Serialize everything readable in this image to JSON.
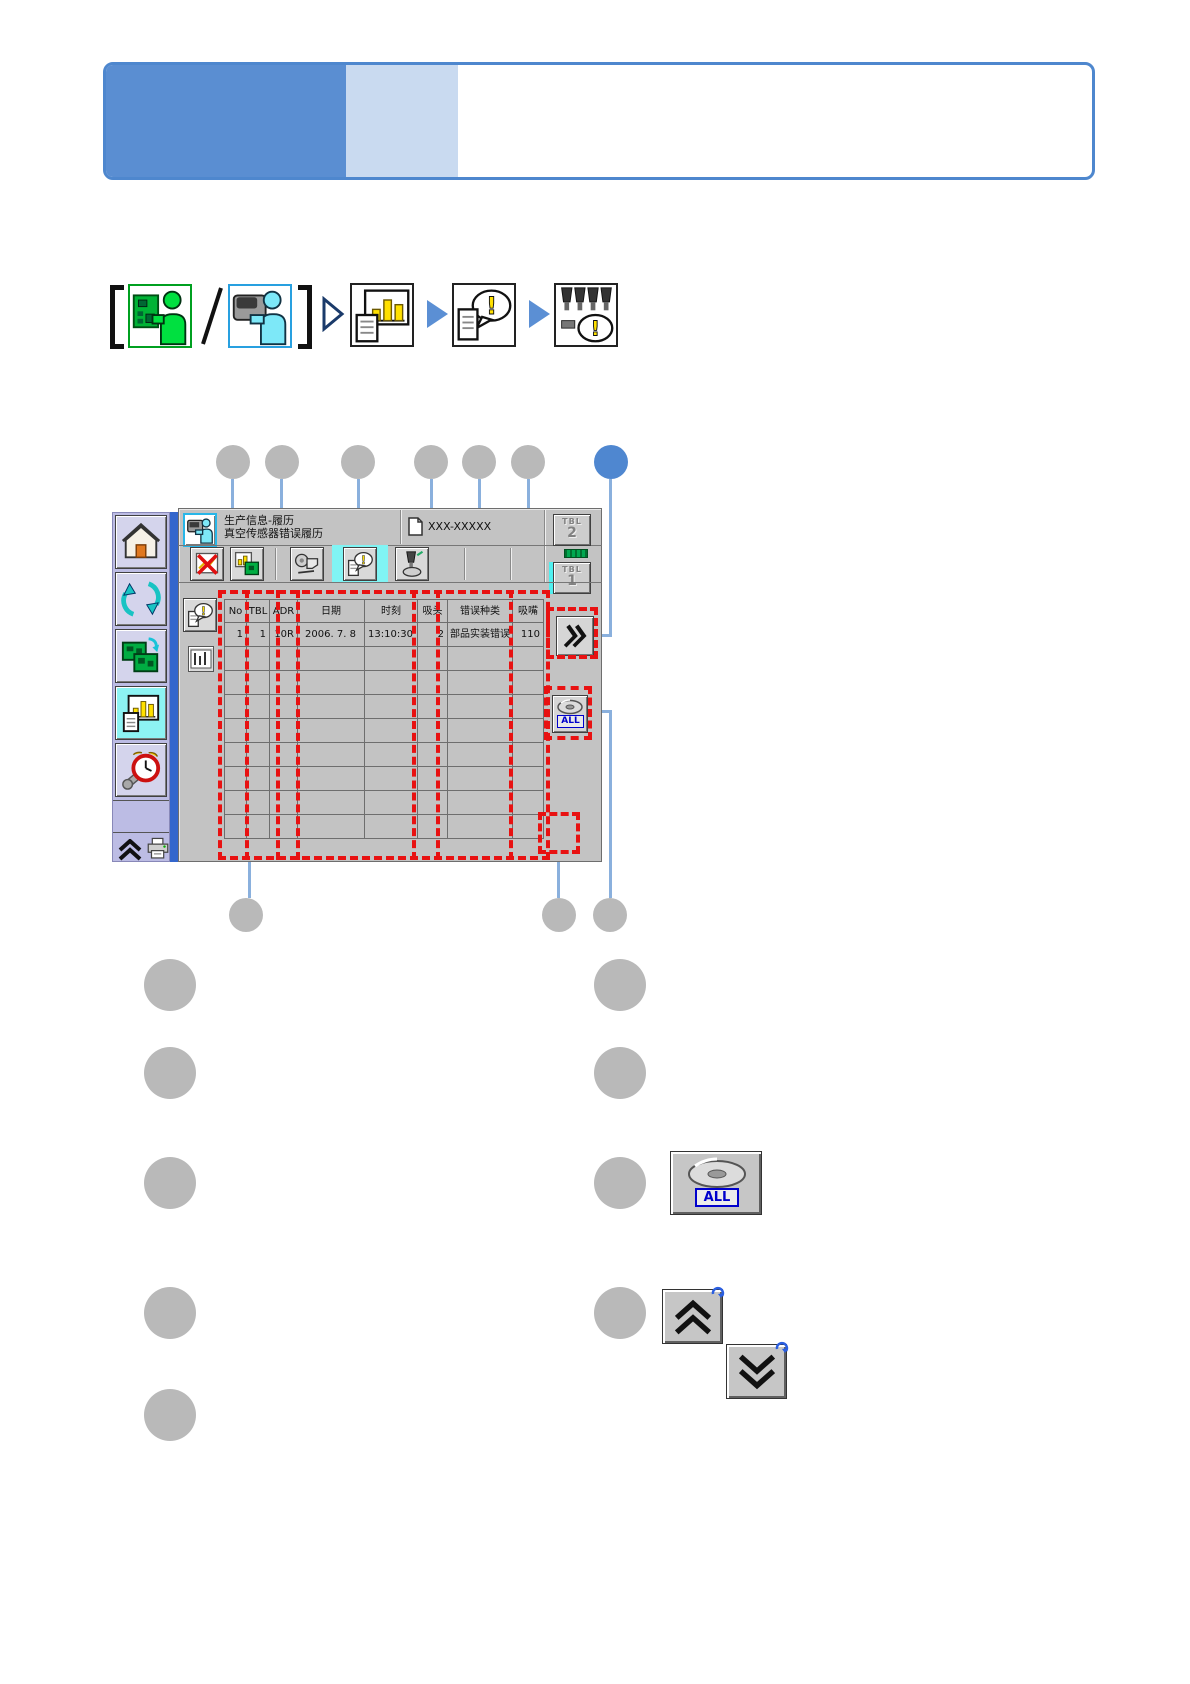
{
  "banner": {
    "accent_color": "#4e87ce",
    "dark_fill": "#5a8ed2",
    "tint_fill": "#c9daf0"
  },
  "nav": {
    "open_bracket": "[",
    "slash": "/",
    "close_bracket": "]",
    "icons": [
      "pcb-operator",
      "machine-operator",
      "production-info",
      "error-history",
      "nozzle-error"
    ]
  },
  "machine_ui": {
    "titlebar": {
      "title_line1": "生产信息-履历",
      "title_line2": "真空传感器错误履历",
      "doc_label": "XXX-XXXXX"
    },
    "tbl2": {
      "top": "TBL",
      "num": "2"
    },
    "tbl1": {
      "top": "TBL",
      "num": "1"
    },
    "all_label": "ALL",
    "table": {
      "headers": [
        "No",
        "TBL",
        "ADR",
        "日期",
        "时刻",
        "吸头",
        "错误种类",
        "吸嘴"
      ],
      "col_widths": [
        23,
        24,
        29,
        68,
        54,
        31,
        66,
        32
      ],
      "aligns": [
        "right",
        "right",
        "right",
        "center",
        "center",
        "right",
        "left",
        "right"
      ],
      "rows": [
        [
          "1",
          "1",
          "10R",
          "2006. 7. 8",
          "13:10:30",
          "2",
          "部品实装错误",
          "110"
        ]
      ],
      "empty_rows": 8
    }
  },
  "legend": {
    "all_button_label": "ALL"
  },
  "colors": {
    "highlight_red": "#e81111",
    "callout_gray": "#b9b9b9",
    "callout_blue": "#4f87d0",
    "connector_blue": "#8ab0dd",
    "ui_silver": "#c3c3c3",
    "select_cyan": "#80f4f4",
    "sidebar_lavender": "#bcbce4",
    "status_green": "#00a850"
  }
}
